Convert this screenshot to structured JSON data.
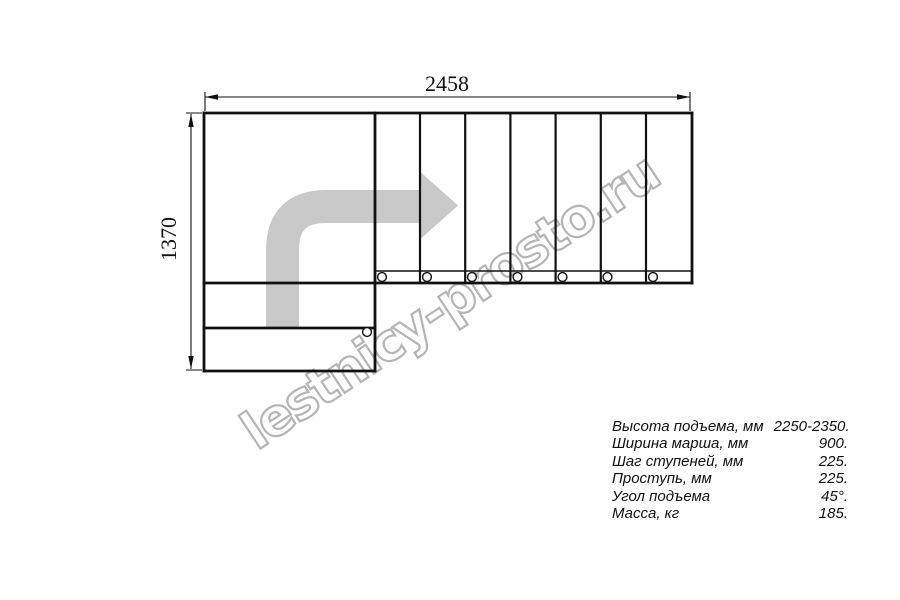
{
  "diagram": {
    "title": "L-shaped staircase plan drawing",
    "width_dimension": "2458",
    "height_dimension": "1370"
  },
  "watermark": {
    "text": "lestnicy-prosto.ru"
  },
  "specs": {
    "rows": [
      {
        "label": "Высота подъема, мм",
        "value": "2250-2350."
      },
      {
        "label": "Ширина марша, мм",
        "value": "900."
      },
      {
        "label": "Шаг ступеней, мм",
        "value": "225."
      },
      {
        "label": "Проступь, мм",
        "value": "225."
      },
      {
        "label": "Угол подъема",
        "value": "45°."
      },
      {
        "label": "Масса, кг",
        "value": "185."
      }
    ]
  },
  "colors": {
    "line": "#111111",
    "arrow": "#c9c9c9",
    "watermark_outline": "#b5b5b5",
    "background": "#ffffff"
  }
}
